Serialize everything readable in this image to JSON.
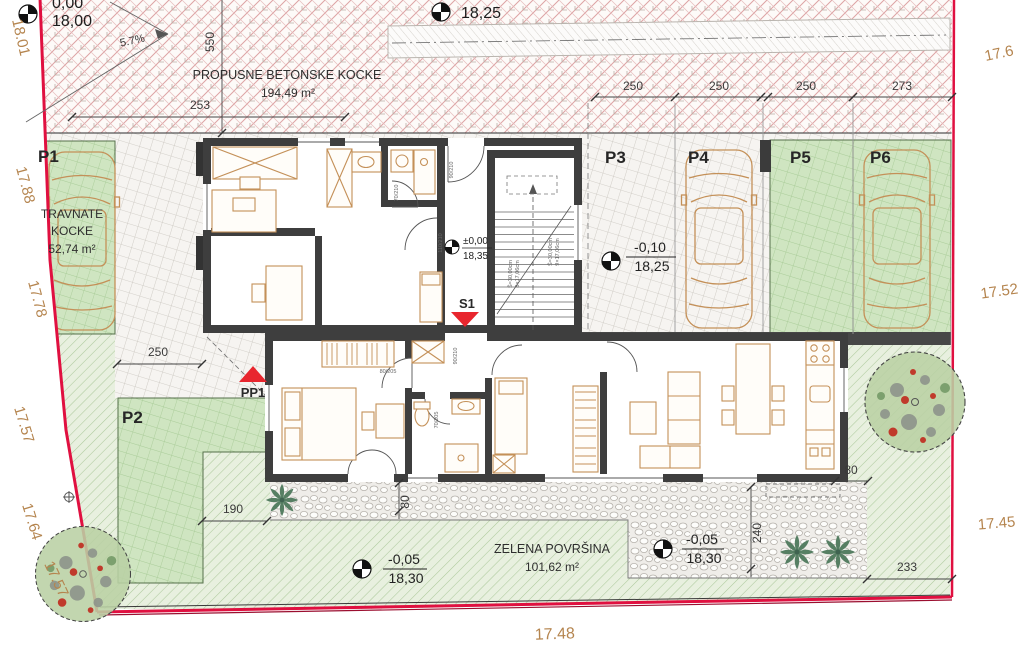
{
  "drawing_type": "site-plan-floor-plan",
  "colors": {
    "boundary_red": "#e01040",
    "triangle_red": "#e8262e",
    "wall_dark": "#3e3e3e",
    "green_pavers": "#cfe5c1",
    "lawn_green": "#e8f0df",
    "crosshatch_pink": "#dda3a5",
    "furniture_tan": "#c49058",
    "boundary_label_tan": "#b5854f"
  },
  "areas": {
    "concrete_blocks": {
      "name": "PROPUSNE BETONSKE KOCKE",
      "area": "194,49 m²"
    },
    "grass_pavers": {
      "name_line1": "TRAVNATE",
      "name_line2": "KOCKE",
      "area": "52,74 m²"
    },
    "green_surface": {
      "name": "ZELENA POVRŠINA",
      "area": "101,62 m²"
    }
  },
  "parking_labels": {
    "p1": "P1",
    "p2": "P2",
    "p3": "P3",
    "p4": "P4",
    "p5": "P5",
    "p6": "P6"
  },
  "slope": {
    "value": "5.7%"
  },
  "elevation_markers": {
    "driveway_top": {
      "partial": "0,00",
      "value": "18,00"
    },
    "ramp_top": {
      "value": "18,25"
    },
    "entrance": {
      "relative": "±0,00",
      "absolute": "18,35"
    },
    "parking_p3": {
      "relative": "-0,10",
      "absolute": "18,25"
    },
    "garden_west": {
      "relative": "-0,05",
      "absolute": "18,30"
    },
    "garden_east": {
      "relative": "-0,05",
      "absolute": "18,30"
    }
  },
  "dimensions": {
    "top_left": "253",
    "driveway_depth": "550",
    "p3_width": "250",
    "p4_width": "250",
    "p5_width": "250",
    "p6_width": "273",
    "p2_width": "250",
    "garden_gap": "190",
    "terrace_depth": "80",
    "patio_depth": "240",
    "corner_offset": "80",
    "east_strip": "233"
  },
  "boundary_labels": {
    "west1": "18.01",
    "west2": "17.88",
    "west3": "17.78",
    "west4": "17.57",
    "west5": "17.64",
    "west6": "17.57",
    "south": "17.48",
    "east1": "17.6",
    "east2": "17.52",
    "east3": "17.45"
  },
  "points": {
    "s1": "S1",
    "pp1": "PP1"
  },
  "stairs": {
    "tread_a": "Š=30,00cm",
    "riser_a": "8×17,06cm",
    "tread_b": "Š=30,00cm",
    "riser_b": "9×17,06cm"
  },
  "door_labels": {
    "d1": "90/210",
    "d2": "70/210",
    "d3": "110/210",
    "d4": "80/205",
    "d5": "90/210",
    "d6": "70/205"
  }
}
